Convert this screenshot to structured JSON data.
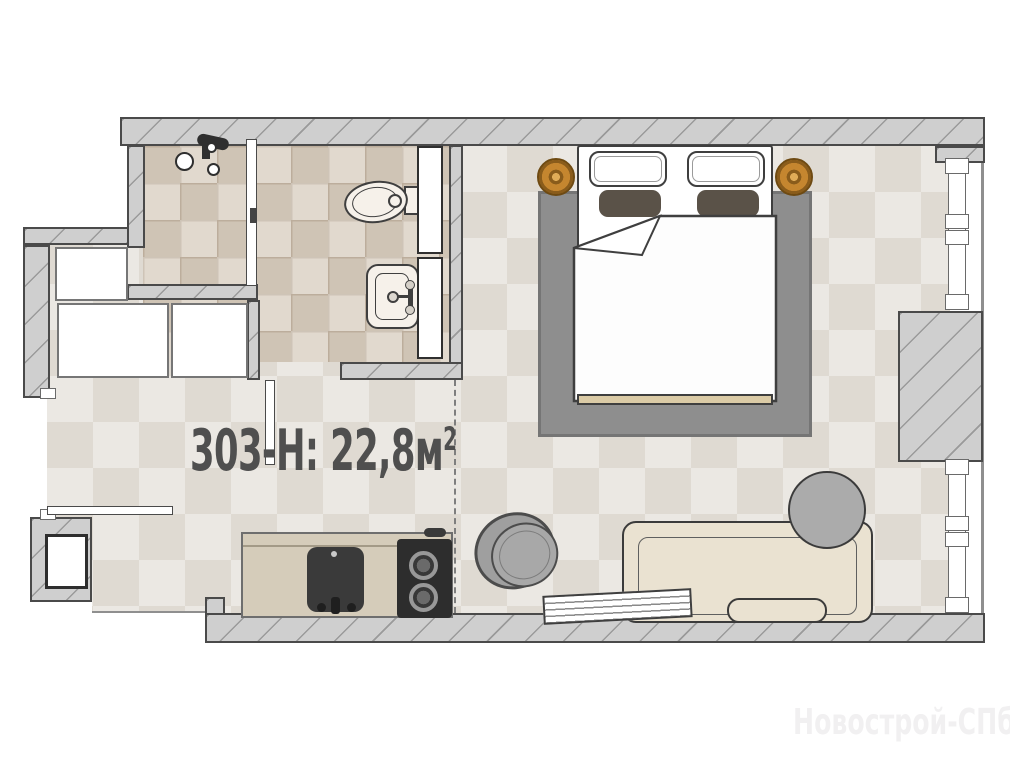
{
  "title": {
    "main": "303-Н: 22,8м",
    "sup": "2"
  },
  "watermark": "Новострой-СПб",
  "colors": {
    "wall": "#cfcfcf",
    "wall-line": "#8f8f8f",
    "ink": "#4a4a4a",
    "floor-a": "#ebe8e3",
    "floor-b": "#dfdad2",
    "tile": "#d9cfc2",
    "grout": "#c2b5a5",
    "counter": "#d5ccba",
    "rug": "#8e8e8e",
    "wood": "#c5862f",
    "sofa": "#eae2d1",
    "furn-gray": "#a8a8a8",
    "appliance": "#2d2d2d",
    "fixture": "#f6f1ea",
    "title-color": "#4f4f4f",
    "watermark-color": "#f1f0f1"
  }
}
